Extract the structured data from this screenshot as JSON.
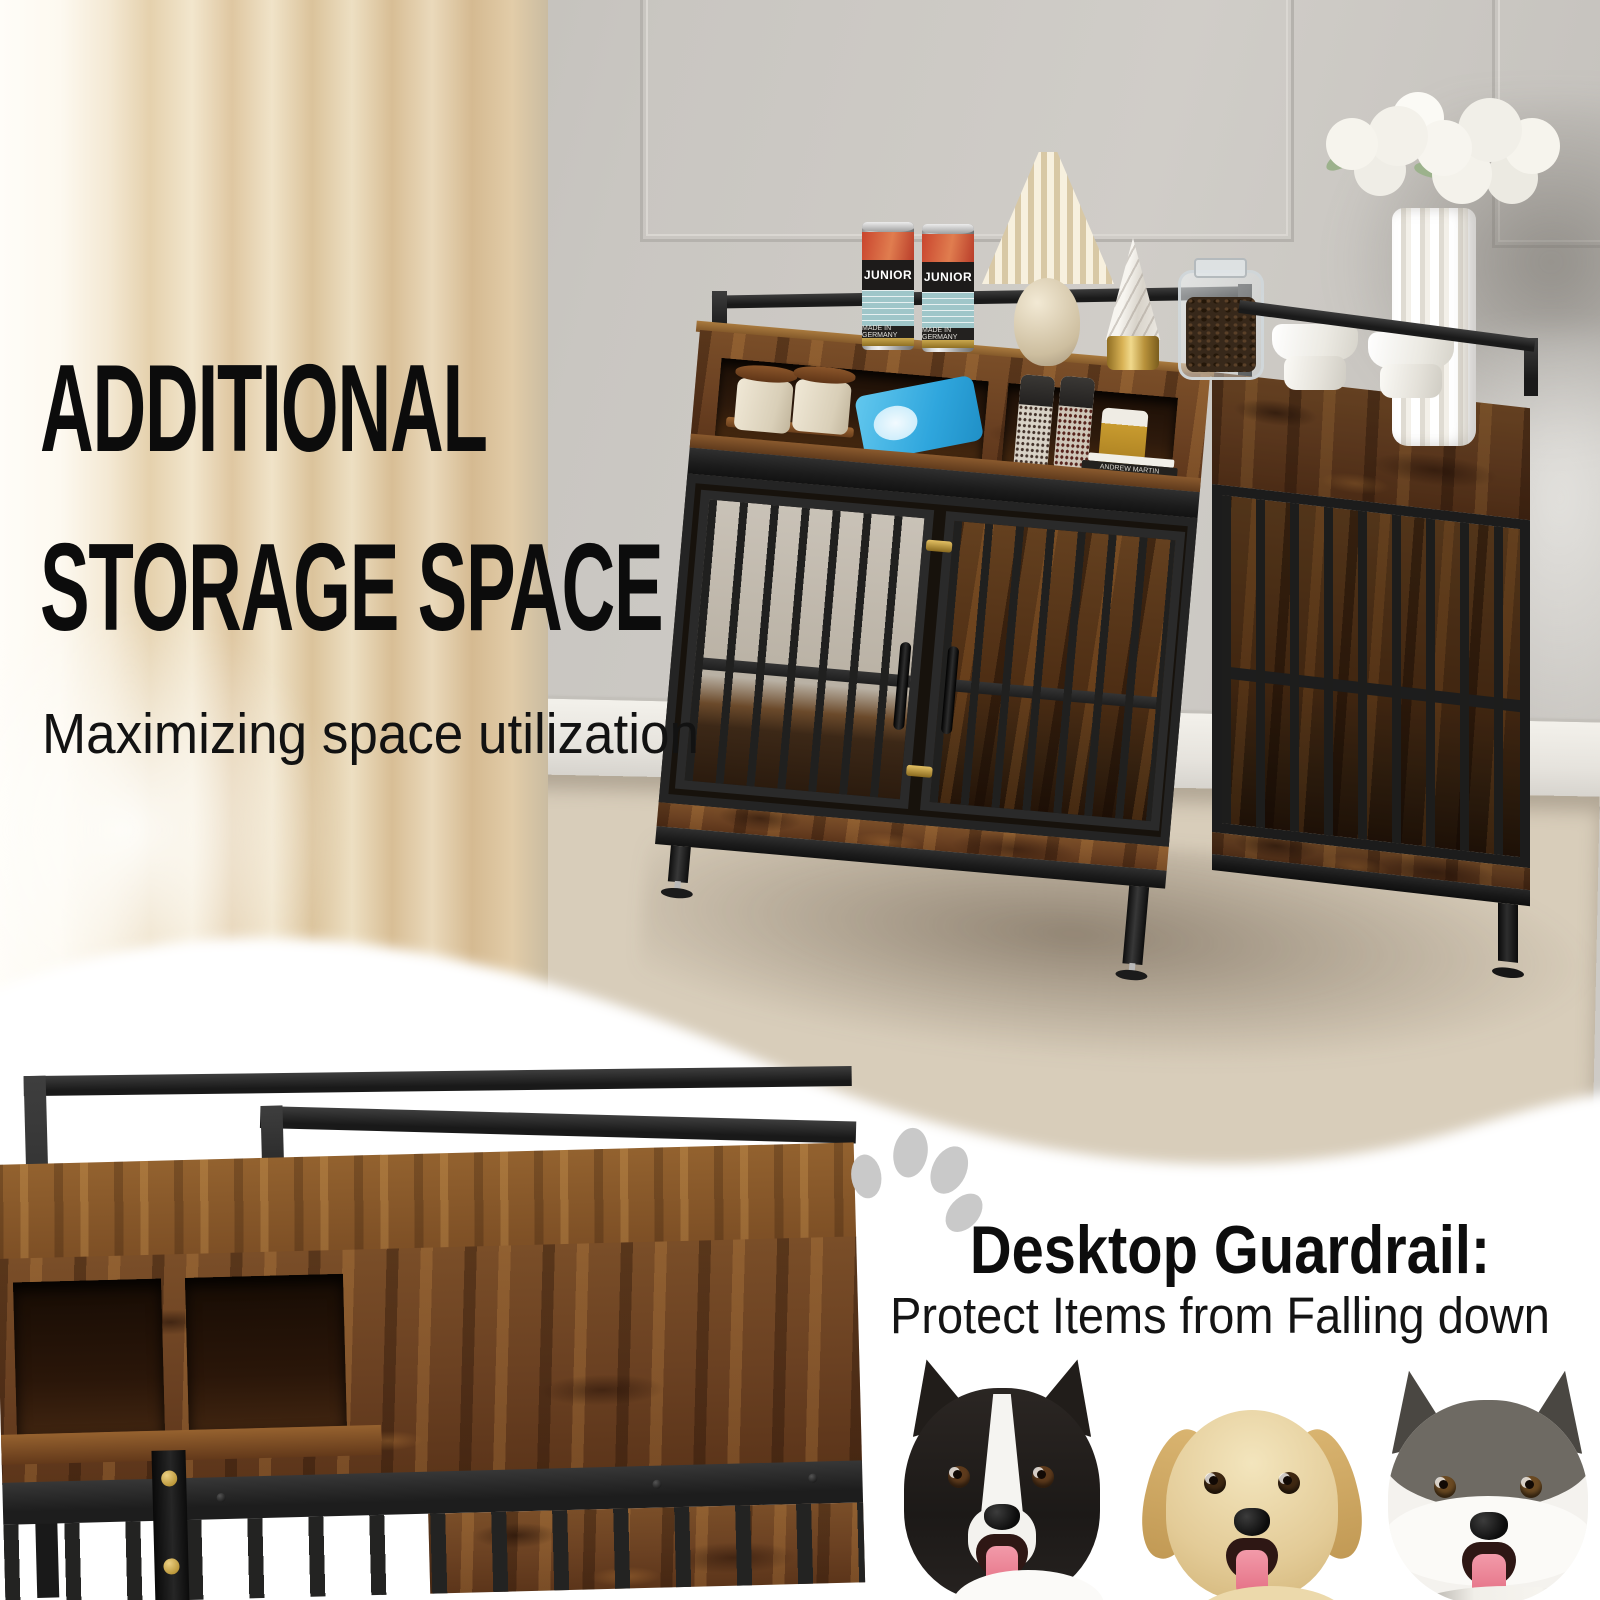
{
  "banner": {
    "background_color": "#ffffff",
    "headline": {
      "line1": "ADDITIONAL",
      "line2": "STORAGE SPACE",
      "subtitle": "Maximizing space utilization",
      "text_color": "#0c0c0c"
    },
    "feature": {
      "title": "Desktop Guardrail:",
      "description": "Protect Items from Falling down",
      "icon": "paw-icon",
      "icon_color": "#c9c9c9"
    }
  },
  "room_scene": {
    "subject": "dog-crate-furniture-with-storage-in-living-room",
    "wall_color": "#c8c5c0",
    "curtain_color": "#ead8b9",
    "floor_color": "#d8cdba",
    "crate": {
      "wood_color": "#6b4423",
      "metal_color": "#1d1d1d",
      "can_label": "JUNIOR",
      "can_origin_text": "MADE IN GERMANY",
      "book_spine": "ANDREW MARTIN",
      "top_items": [
        "junior-cans",
        "pleated-lamp",
        "ceramic-tree",
        "bean-jar",
        "pet-bowls",
        "fluted-vase",
        "white-flowers"
      ],
      "cubby_items": [
        "wooden-canisters",
        "snack-bag",
        "pepper-grinders",
        "mustard-jar",
        "books"
      ]
    }
  },
  "closeup": {
    "subject": "crate-desktop-guardrail-corner-closeup"
  },
  "dogs": [
    {
      "breed": "border-collie"
    },
    {
      "breed": "golden-retriever"
    },
    {
      "breed": "siberian-husky"
    }
  ]
}
